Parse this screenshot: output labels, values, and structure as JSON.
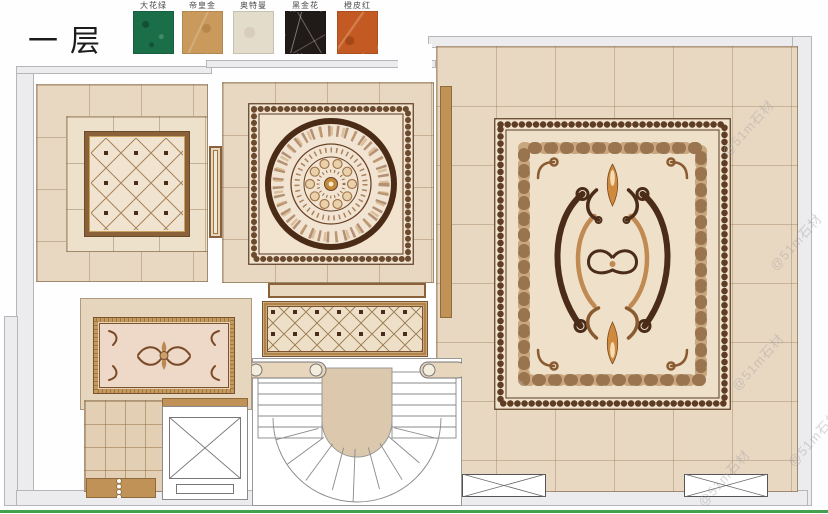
{
  "title": "一层",
  "legend": {
    "items": [
      {
        "label": "大花绿",
        "color": "#1a6e48"
      },
      {
        "label": "帝皇金",
        "color": "#c99a5b"
      },
      {
        "label": "奥特曼",
        "color": "#e3dccb"
      },
      {
        "label": "黑金花",
        "color": "#201a19"
      },
      {
        "label": "橙皮红",
        "color": "#c45a23"
      }
    ]
  },
  "watermark": {
    "text": "@51m石材"
  },
  "colors": {
    "floor_beige": "#e9d8c1",
    "tile_band_light": "#eee1cb",
    "frame_brown": "#8a6138",
    "accent_tan": "#c09257",
    "ornament_dark": "#4a2c18",
    "ornament_gold": "#c08a52",
    "wall_gray": "#ececee",
    "bottom_line_green": "#44a04c"
  }
}
